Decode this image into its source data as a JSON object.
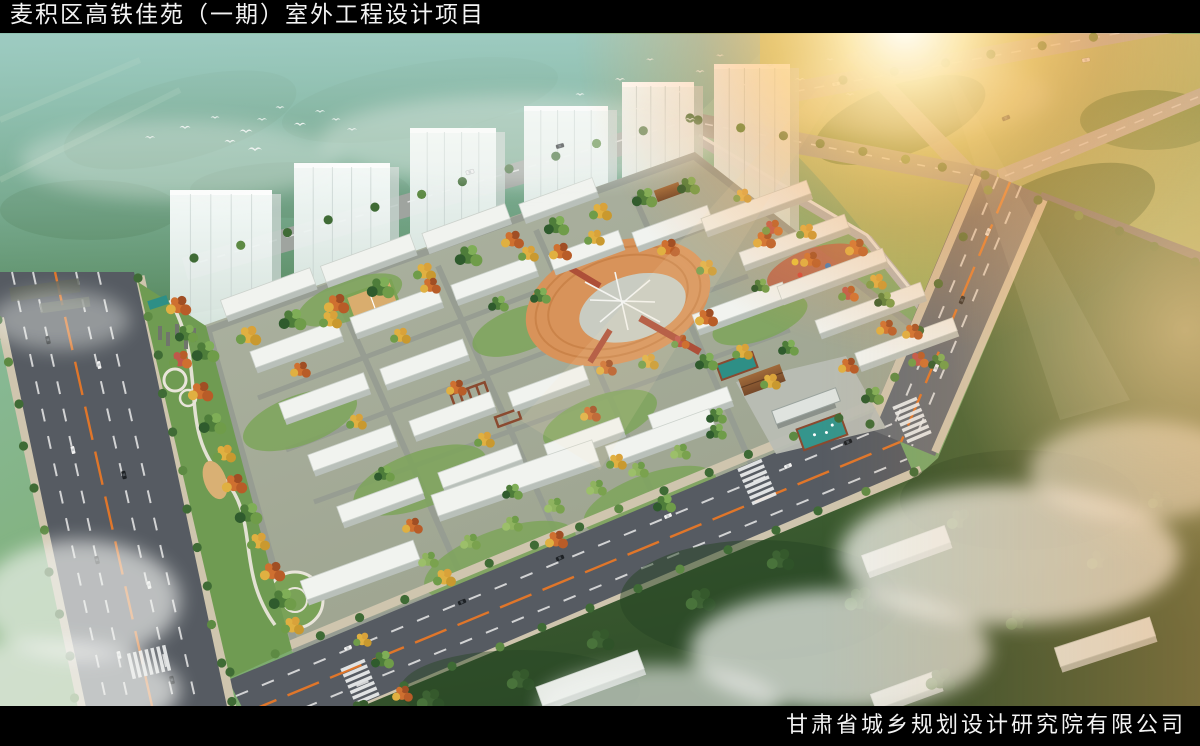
{
  "header": {
    "title": "麦积区高铁佳苑（一期）室外工程设计项目"
  },
  "footer": {
    "company": "甘肃省城乡规划设计研究院有限公司"
  },
  "scene": {
    "residential_towers": 6
  },
  "palette": {
    "bar_bg": "#000000",
    "bar_text": "#f3f3f3",
    "road": "#565b62",
    "road_far": "#9fa49f",
    "road_sun": "#b9bab2",
    "lane_white": "#e8e8e8",
    "lane_orange": "#e0762a",
    "sidewalk": "#cfc5ae",
    "site_ground": "#a9af9f",
    "path": "#969c92",
    "roof": "#f1f3ef",
    "bldg_side": "#b9c0ba",
    "tree_green": "#4e7d3a",
    "tree_yellow": "#e0b041",
    "tree_orange": "#cf7030",
    "plaza_orange": "#d8935a",
    "plaza_inner": "#c9ccc2",
    "red_path": "#ad4f38",
    "pool_teal": "#2e8f86",
    "canopy_brown": "#8a5a33",
    "wall": "#b3b9bc",
    "sun_glow": "#ffcf7e",
    "mist": "#f2f4f1",
    "hills_teal": "#8fc2b4",
    "forest_dark": "#3a5c31"
  }
}
